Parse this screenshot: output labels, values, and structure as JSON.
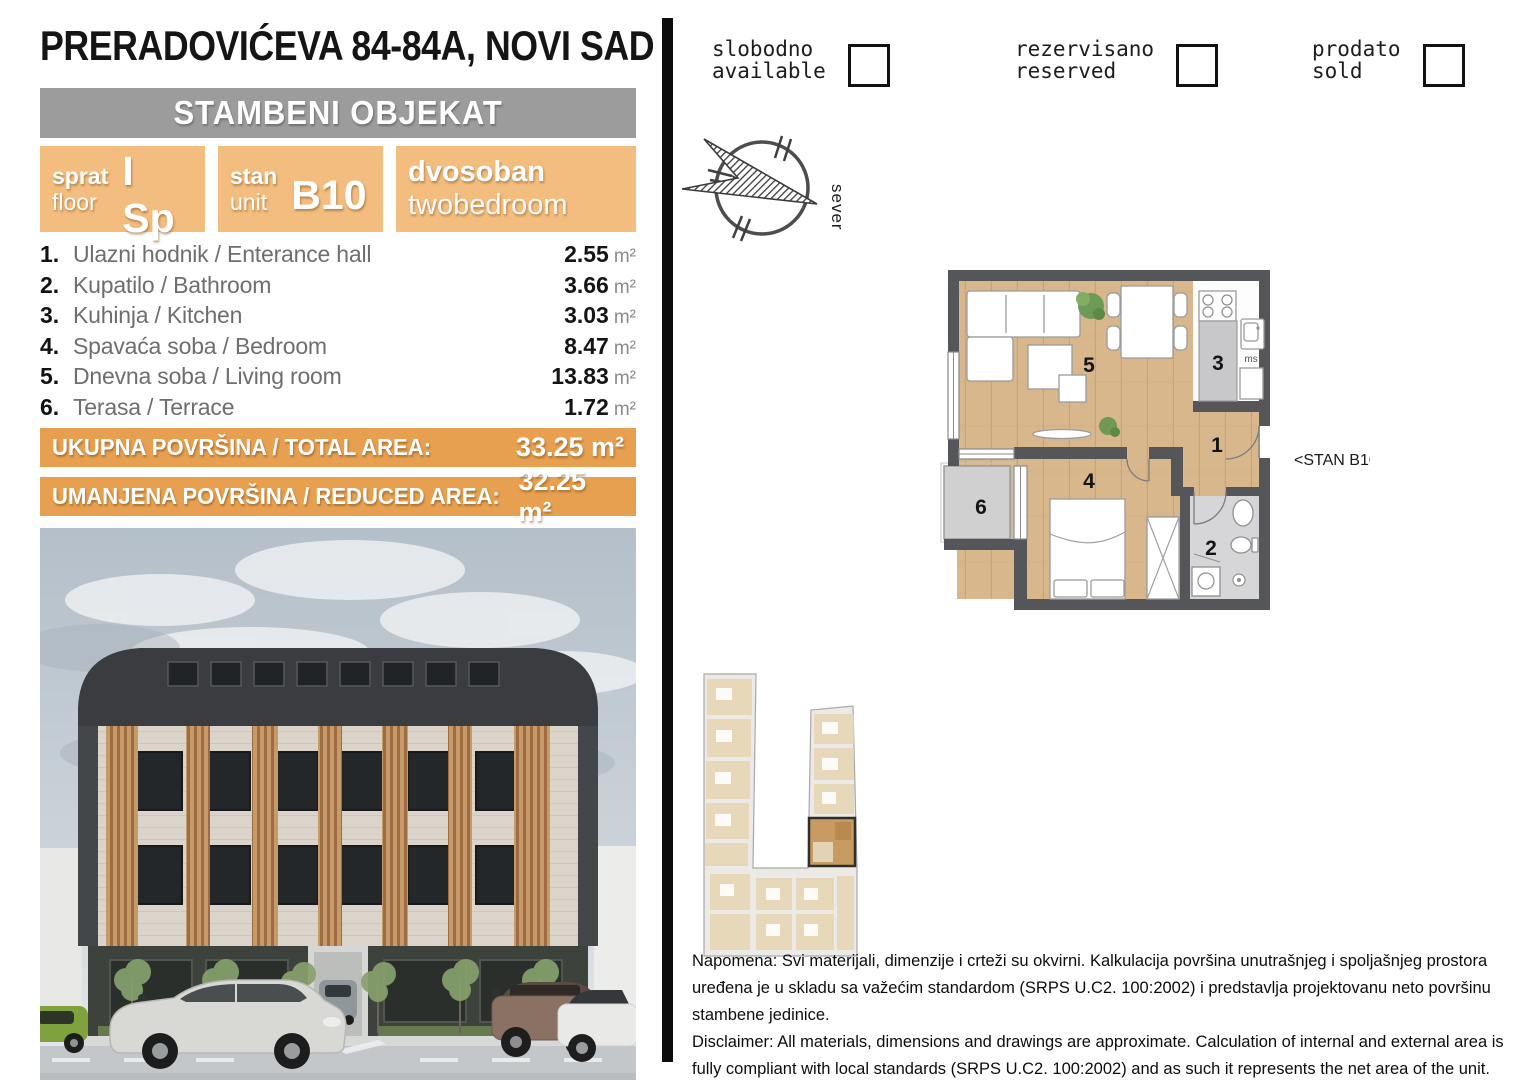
{
  "header": {
    "title": "PRERADOVIĆEVA 84-84A, NOVI SAD",
    "building_type": "STAMBENI OBJEKAT"
  },
  "info_boxes": {
    "floor": {
      "label_sr": "sprat",
      "label_en": "floor",
      "value": "I Sp"
    },
    "unit": {
      "label_sr": "stan",
      "label_en": "unit",
      "value": "B10"
    },
    "layout": {
      "label_sr": "dvosoban",
      "label_en": "twobedroom"
    }
  },
  "rooms": [
    {
      "num": "1.",
      "name": "Ulazni hodnik / Enterance hall",
      "area": "2.55",
      "unit": "m²"
    },
    {
      "num": "2.",
      "name": "Kupatilo / Bathroom",
      "area": "3.66",
      "unit": "m²"
    },
    {
      "num": "3.",
      "name": "Kuhinja / Kitchen",
      "area": "3.03",
      "unit": "m²"
    },
    {
      "num": "4.",
      "name": "Spavaća soba / Bedroom",
      "area": "8.47",
      "unit": "m²"
    },
    {
      "num": "5.",
      "name": "Dnevna soba / Living room",
      "area": "13.83",
      "unit": "m²"
    },
    {
      "num": "6.",
      "name": "Terasa / Terrace",
      "area": "1.72",
      "unit": "m²"
    }
  ],
  "totals": {
    "total": {
      "label": "UKUPNA POVRŠINA / TOTAL AREA:",
      "value": "33.25 m²"
    },
    "reduced": {
      "label": "UMANJENA POVRŠINA / REDUCED AREA:",
      "value": "32.25 m²"
    }
  },
  "legend": [
    {
      "sr": "slobodno",
      "en": "available"
    },
    {
      "sr": "rezervisano",
      "en": "reserved"
    },
    {
      "sr": "prodato",
      "en": "sold"
    }
  ],
  "compass": {
    "north_label": "sever"
  },
  "floorplan": {
    "unit_pointer": "<STAN B10",
    "kitchen_label": "ms",
    "numbers": {
      "hall": "1",
      "bathroom": "2",
      "kitchen": "3",
      "bedroom": "4",
      "living": "5",
      "terrace": "6"
    }
  },
  "disclaimer": {
    "sr": "Napomena: Svi materijali, dimenzije i crteži su okvirni. Kalkulacija površina unutrašnjeg i spoljašnjeg prostora uređena je u skladu sa važećim standardom (SRPS U.C2. 100:2002) i predstavlja projektovanu neto površinu stambene jedinice.",
    "en": "Disclaimer: All materials, dimensions and drawings are approximate. Calculation of internal and external area is fully compliant with local standards (SRPS U.C2. 100:2002) and as such it represents the net area of the unit."
  },
  "colors": {
    "orange_box": "#f4bd80",
    "orange_banner": "#e6a050",
    "gray_banner": "#9c9c9c",
    "wall": "#55565a",
    "wood": "#d9b78c",
    "bathroom_floor": "#d6d6d8",
    "terrace_floor": "#d0d0d0"
  }
}
